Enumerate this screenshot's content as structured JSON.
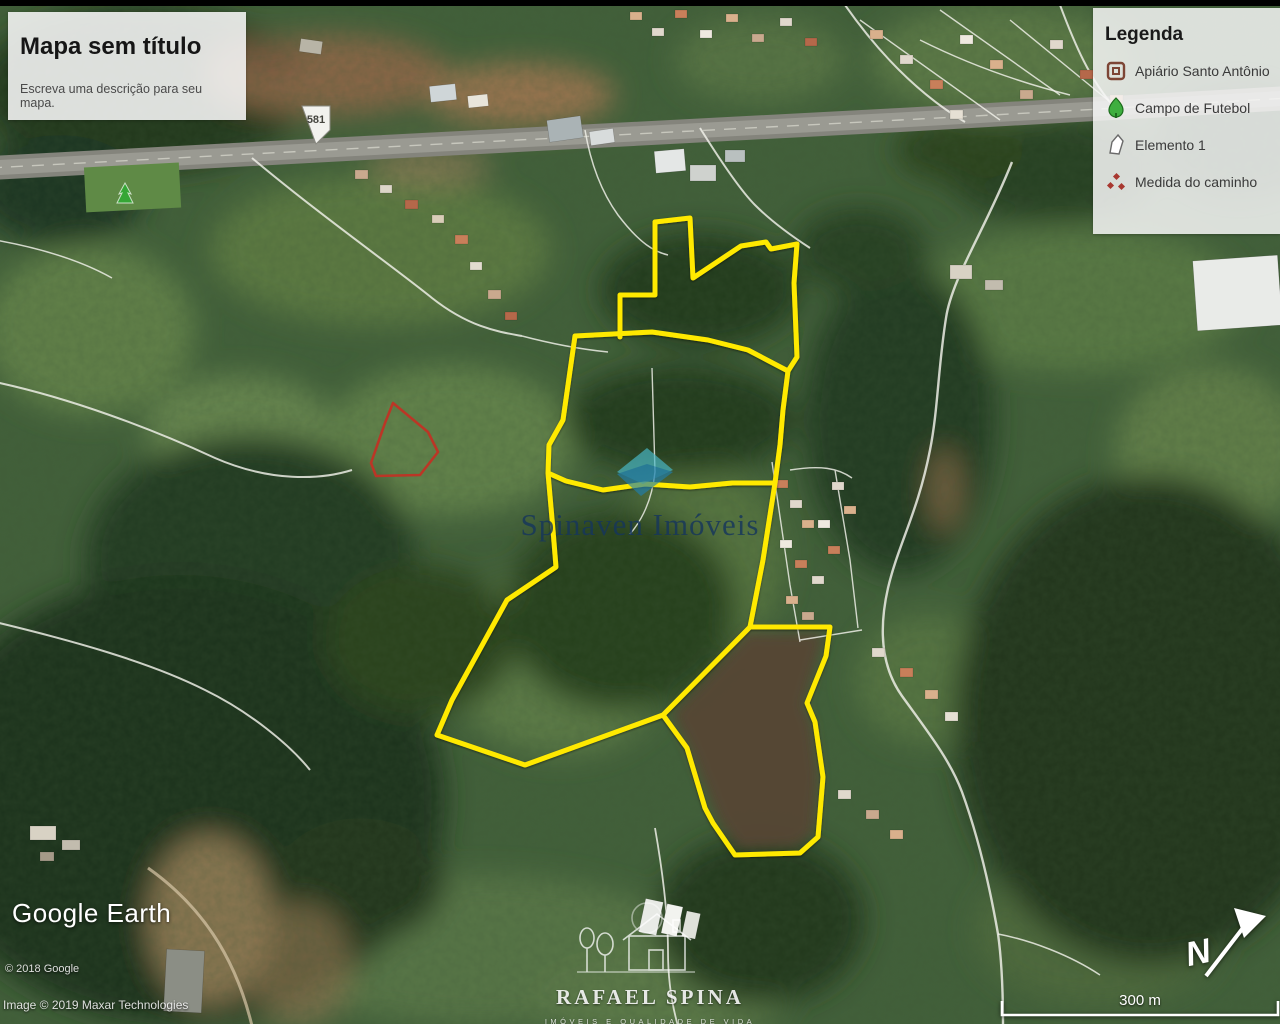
{
  "title_box": {
    "title": "Mapa sem título",
    "subtitle": "Escreva uma descrição para seu mapa."
  },
  "legend": {
    "title": "Legenda",
    "items": [
      {
        "icon": "apiary-marker-icon",
        "label": "Apiário Santo Antônio",
        "color": "#7d4535"
      },
      {
        "icon": "tree-marker-icon",
        "label": "Campo de Futebol",
        "color": "#35a635"
      },
      {
        "icon": "polygon-shape-icon",
        "label": "Elemento 1",
        "color": "#ffffff"
      },
      {
        "icon": "path-measure-icon",
        "label": "Medida do caminho",
        "color": "#a83830"
      }
    ]
  },
  "map": {
    "parcel_outline_color": "#ffe900",
    "measure_polygon_color": "#c03325",
    "road_shield_label": "581"
  },
  "watermarks": {
    "center": {
      "name": "Spinaven Imóveis"
    },
    "bottom": {
      "name": "RAFAEL SPINA",
      "tagline": "IMÓVEIS E QUALIDADE DE VIDA"
    }
  },
  "attribution": {
    "brand": "Google Earth",
    "line1": "© 2018 Google",
    "line2": "Image © 2019 Maxar Technologies"
  },
  "scale_bar": {
    "label": "300 m"
  },
  "compass": {
    "label": "N"
  }
}
